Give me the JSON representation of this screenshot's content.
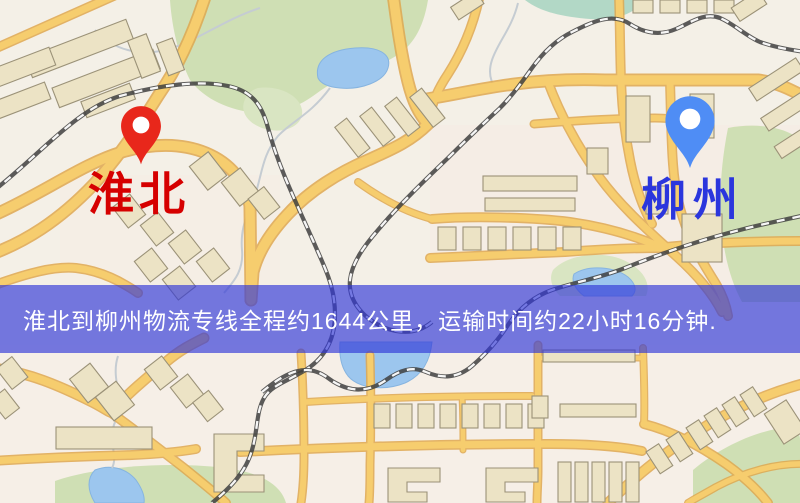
{
  "origin": {
    "label": "淮北",
    "pin_color": "#e8271b",
    "label_color": "#d60000"
  },
  "destination": {
    "label": "柳州",
    "pin_color": "#4f8df5",
    "label_color": "#2b36dd"
  },
  "banner": {
    "text": "淮北到柳州物流专线全程约1644公里，运输时间约22小时16分钟.",
    "background_color": "#3037d7",
    "text_color": "#ffffff"
  },
  "map_palette": {
    "land": "#f4f0e7",
    "road_fill": "#f6cd6e",
    "road_casing": "#dfa850",
    "building": "#ece3c5",
    "green_area": "#cfdfb4",
    "water": "#9cc6ee",
    "railway": "#3f3f3f"
  }
}
